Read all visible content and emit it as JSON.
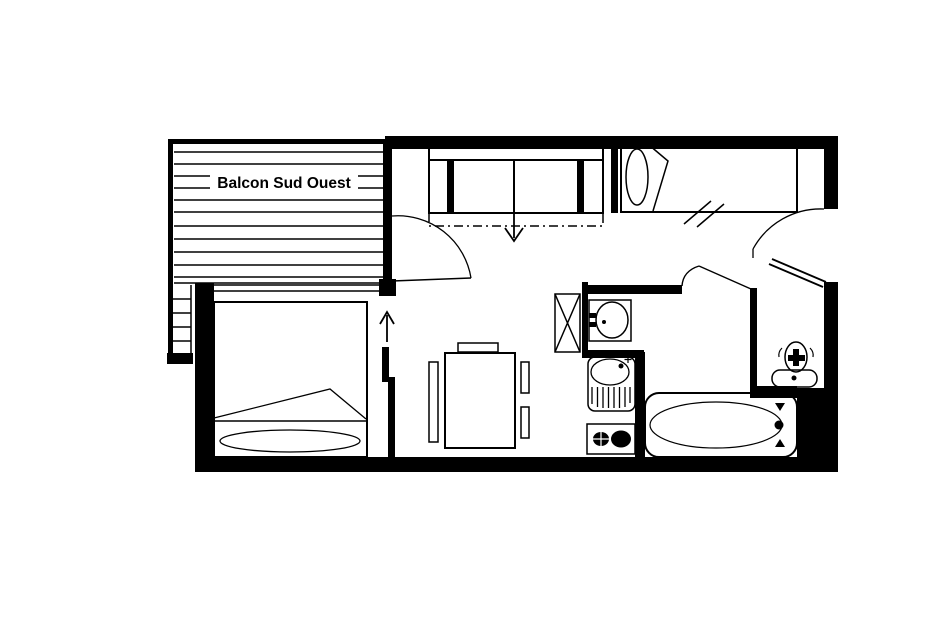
{
  "page": {
    "background": "#ffffff",
    "line_color": "#000000"
  },
  "floor_plan": {
    "balcony": {
      "label": "Balcon Sud Ouest"
    },
    "rooms": [
      {
        "name": "balcony"
      },
      {
        "name": "bedroom"
      },
      {
        "name": "living-dining-room"
      },
      {
        "name": "kitchenette"
      },
      {
        "name": "bathroom"
      },
      {
        "name": "wc"
      },
      {
        "name": "entry-hallway"
      }
    ],
    "fixtures": [
      "sofa-bed-convertible",
      "single-bed",
      "double-bed",
      "dining-table",
      "dining-chairs",
      "closet",
      "washbasin",
      "kitchen-sink-with-drainer",
      "two-burner-cooktop",
      "bathtub",
      "toilet",
      "balcony-door-swing",
      "entry-door-swing",
      "bathroom-door",
      "sliding-door",
      "direction-arrows",
      "level-change-marks"
    ]
  }
}
